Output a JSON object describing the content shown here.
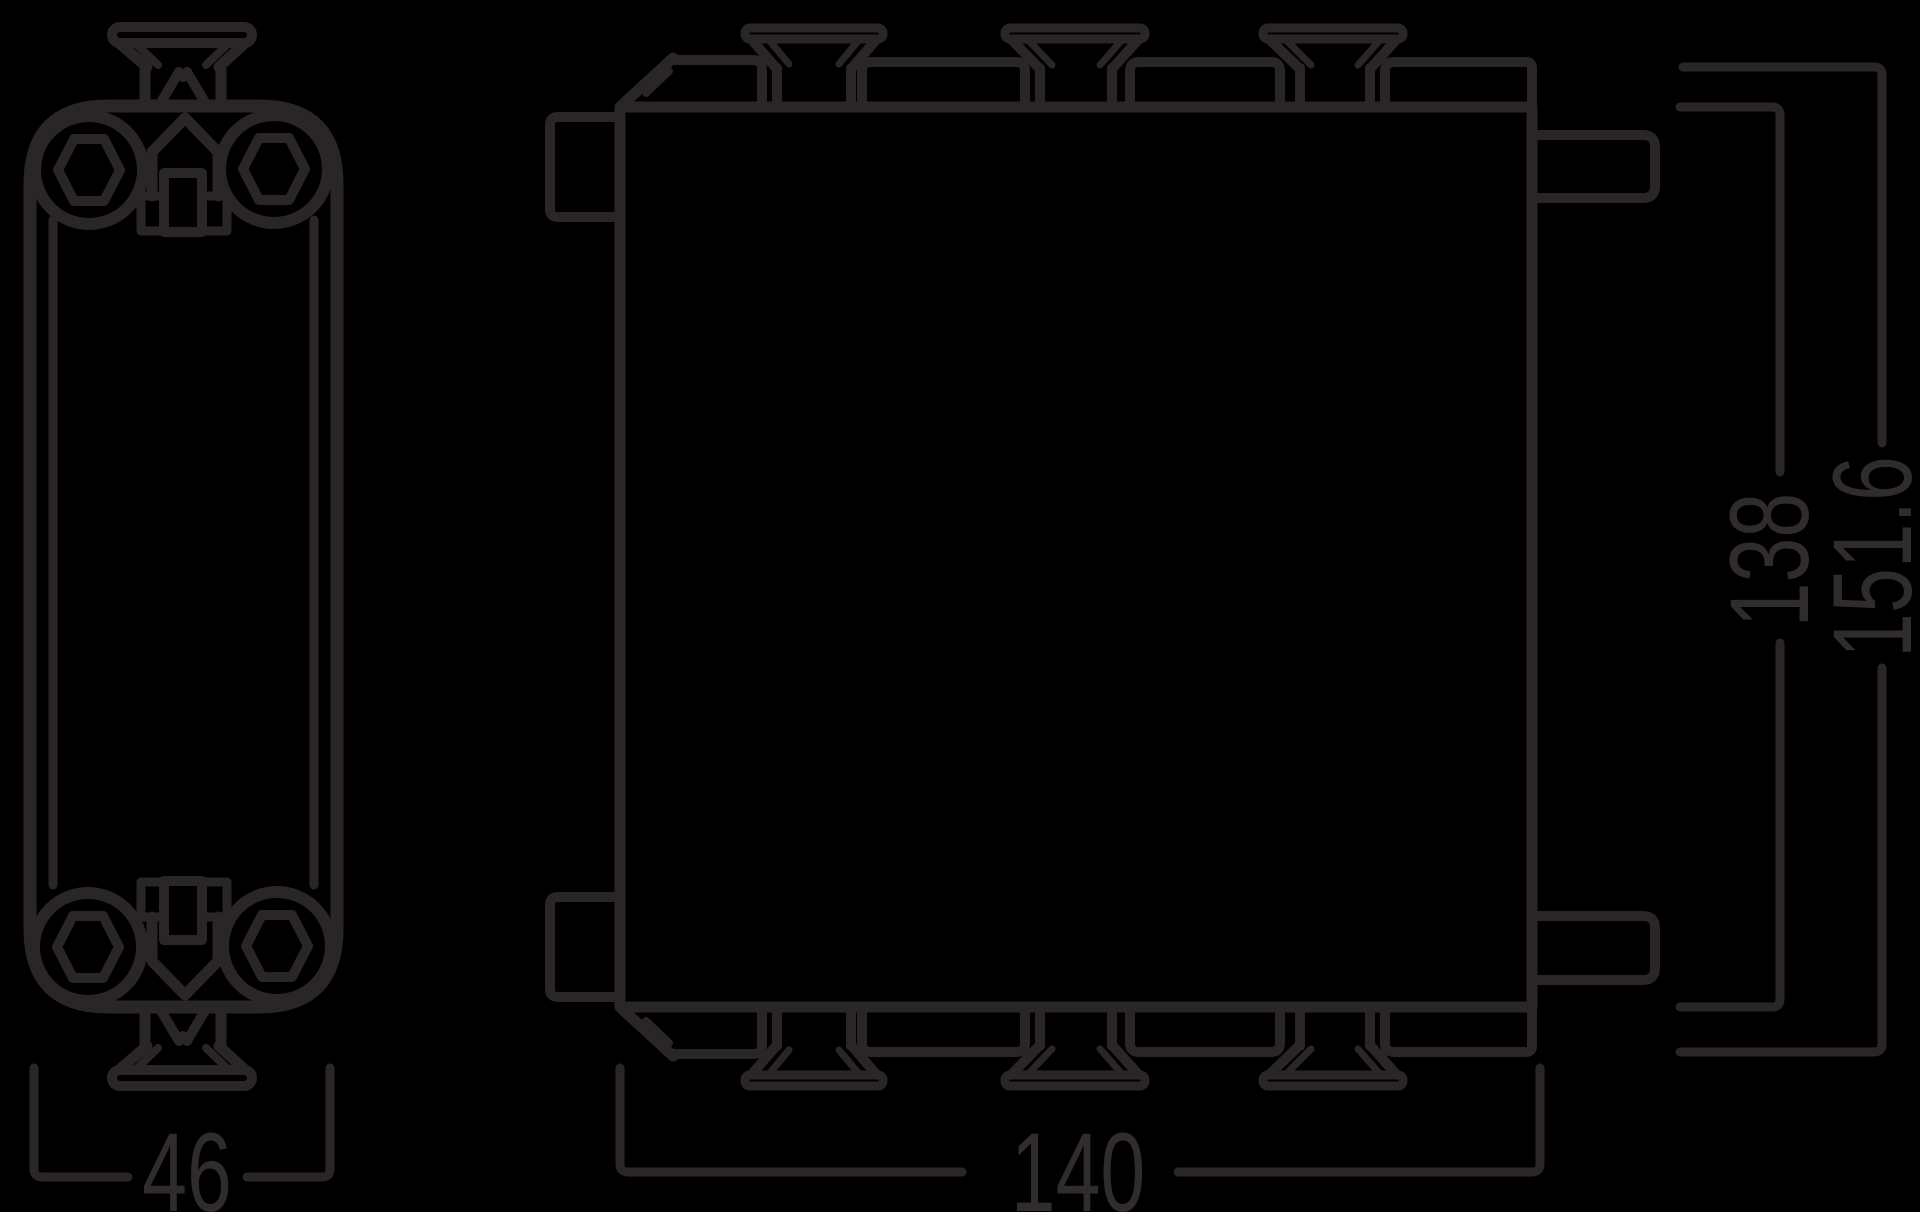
{
  "drawing": {
    "type": "technical-dimension-drawing",
    "background_color": "#000000",
    "line_color": "#2a2627",
    "text_color": "#302b2c",
    "views": {
      "side_view": "plate heat exchanger side profile with top and bottom ports (hex plugs) and clip fittings",
      "front_view": "plate heat exchanger front face with mounting clips on top and bottom edges and side tabs"
    },
    "dimensions": {
      "side_width": {
        "label": "46",
        "orientation": "horizontal"
      },
      "front_width": {
        "label": "140",
        "orientation": "horizontal"
      },
      "front_height": {
        "label": "138",
        "orientation": "vertical-rotated"
      },
      "overall_height": {
        "label": "151.6",
        "orientation": "vertical-rotated"
      }
    }
  }
}
